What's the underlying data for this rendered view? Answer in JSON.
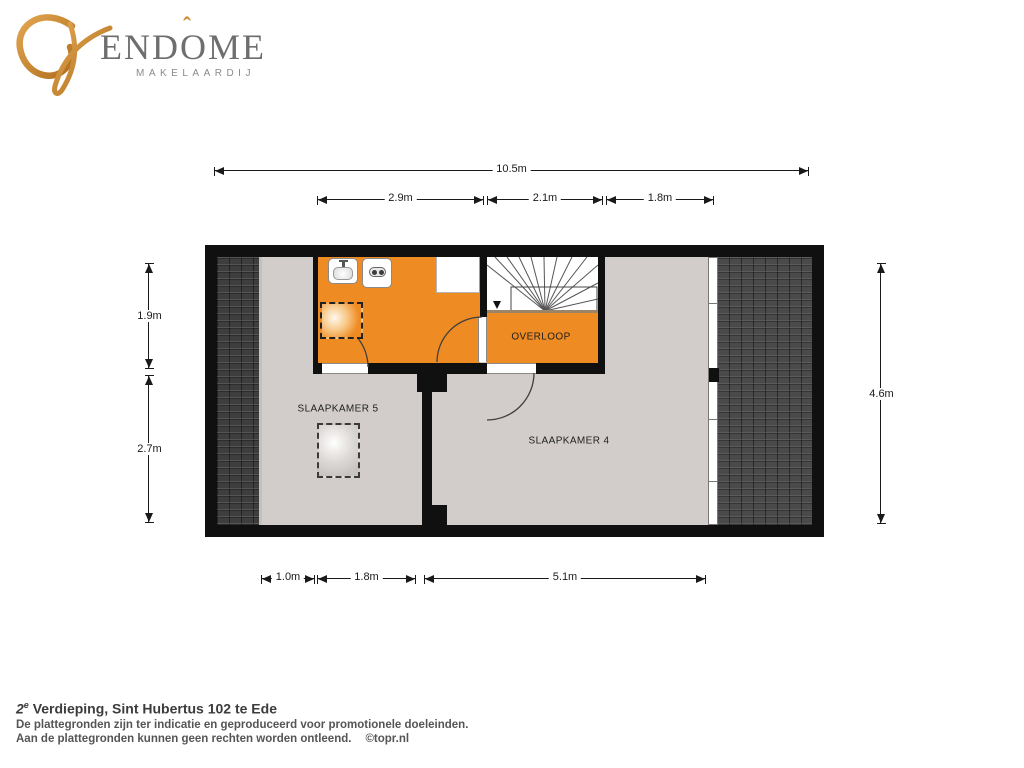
{
  "logo": {
    "name_full": "ENDÔME",
    "name_pre": "END",
    "name_o": "O",
    "accent": "ˆ",
    "name_post": "ME",
    "subtitle": "MAKELAARDIJ",
    "brand_orange": "#cf8a2d",
    "brand_gray": "#6e6e6e"
  },
  "plan": {
    "rooms": {
      "bedroom5": "SLAAPKAMER 5",
      "bedroom4": "SLAAPKAMER 4",
      "landing": "OVERLOOP"
    },
    "dims": {
      "total_width": "10.5m",
      "bath_width": "2.9m",
      "stairs_width": "2.1m",
      "right_width": "1.8m",
      "left_top": "1.9m",
      "left_bottom": "2.7m",
      "right_height": "4.6m",
      "bottom_left": "1.0m",
      "bottom_mid": "1.8m",
      "bottom_right": "5.1m"
    },
    "colors": {
      "accent_orange": "#ef8b23",
      "floor_gray": "#d2cdca",
      "roof_dark": "#3e3e3e",
      "wall_black": "#101010"
    }
  },
  "footer": {
    "floor_number": "2",
    "floor_sup": "e",
    "title_rest": " Verdieping, Sint Hubertus 102 te Ede",
    "line1": "De plattegronden zijn ter indicatie en geproduceerd voor promotionele doeleinden.",
    "line2": "Aan de plattegronden kunnen geen rechten worden ontleend.",
    "credit": "©topr.nl"
  }
}
